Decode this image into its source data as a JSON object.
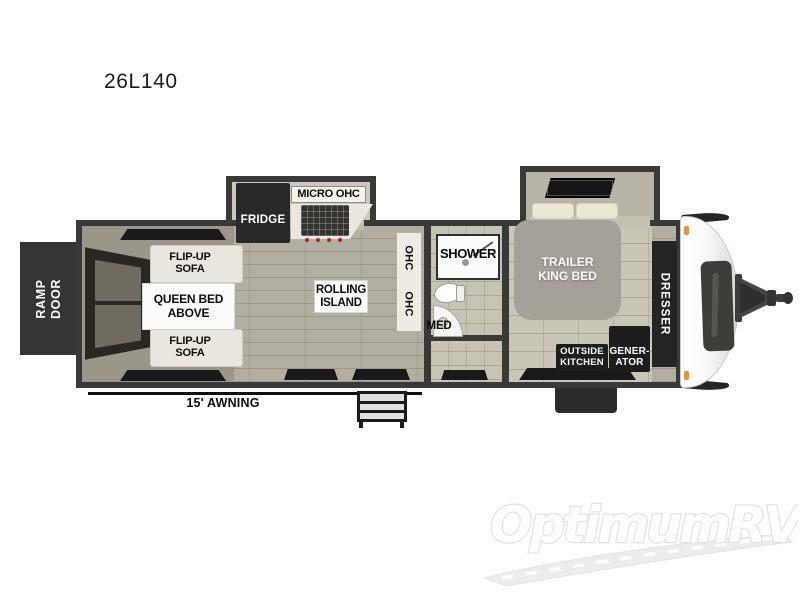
{
  "title": "26L140",
  "plan": {
    "ramp_door": "RAMP\nDOOR",
    "flip_up_sofa_top": "FLIP-UP\nSOFA",
    "queen_bed_above": "QUEEN BED\nABOVE",
    "flip_up_sofa_bottom": "FLIP-UP\nSOFA",
    "fridge": "FRIDGE",
    "micro_ohc": "MICRO OHC",
    "rolling_island": "ROLLING\nISLAND",
    "ohc_upper": "OHC",
    "ohc_lower": "OHC",
    "shower": "SHOWER",
    "med": "MED",
    "trailer_king_bed": "TRAILER\nKING BED",
    "dresser": "DRESSER",
    "outside_kitchen": "OUTSIDE\nKITCHEN",
    "generator": "GENER-\nATOR",
    "awning": "15' AWNING"
  },
  "watermark": "OptimumRV",
  "colors": {
    "wall": "#393939",
    "fixture_dark": "#1d1d1d",
    "marker_light": "#e8912d",
    "floor_wood": "#b2aea1",
    "floor_bedroom": "#c9c5b7",
    "watermark_gray": "#e1e1e1"
  }
}
